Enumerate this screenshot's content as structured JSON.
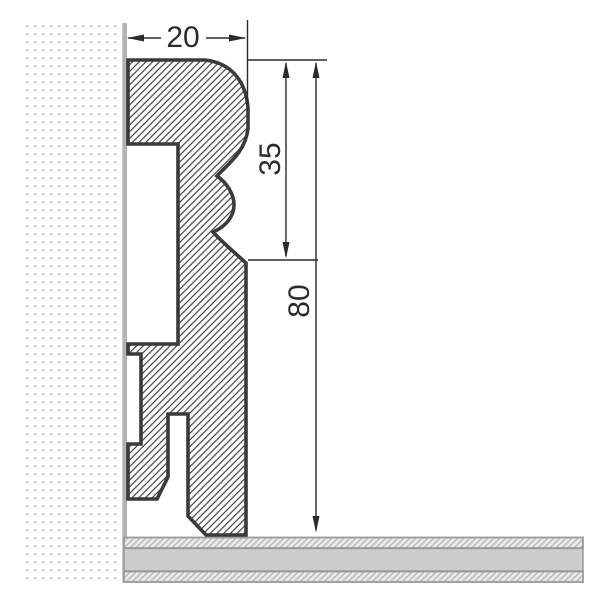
{
  "drawing": {
    "dimensions": {
      "top_width": "20",
      "upper_height": "35",
      "total_height": "80"
    },
    "colors": {
      "dimension_ink": "#2b2b2b",
      "profile_outline": "#3a3a3a",
      "profile_hatch": "#3d3d3d",
      "wall_dots": "#c9c9c9",
      "wall_surface": "#b3b3b3",
      "floor_middle": "#cdcdcd",
      "floor_underlay_bg": "#e9e9e9",
      "floor_underlay_hatch": "#b5b5b5",
      "floor_border": "#9a9a9a"
    }
  }
}
